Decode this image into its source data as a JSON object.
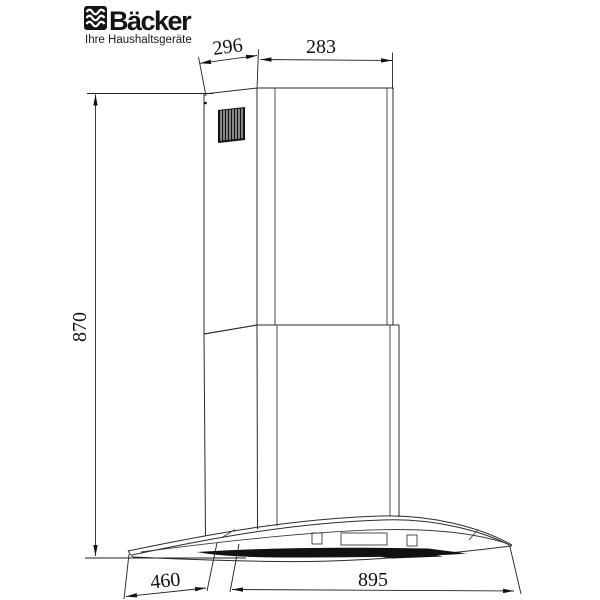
{
  "brand": {
    "name": "Bäcker",
    "tagline": "Ihre Haushaltsgeräte",
    "logo_icon": "steam-waves-icon"
  },
  "figure": {
    "kind": "technical dimension drawing",
    "subject": "wall chimney cooker hood with curved glass canopy, telescopic flue duct and vent grille"
  },
  "dims": {
    "top_depth": "296",
    "top_width": "283",
    "height": "870",
    "hood_depth": "460",
    "hood_width": "895"
  },
  "colors": {
    "background": "#ffffff",
    "line": "#2b2b2b",
    "ink": "#111111"
  }
}
